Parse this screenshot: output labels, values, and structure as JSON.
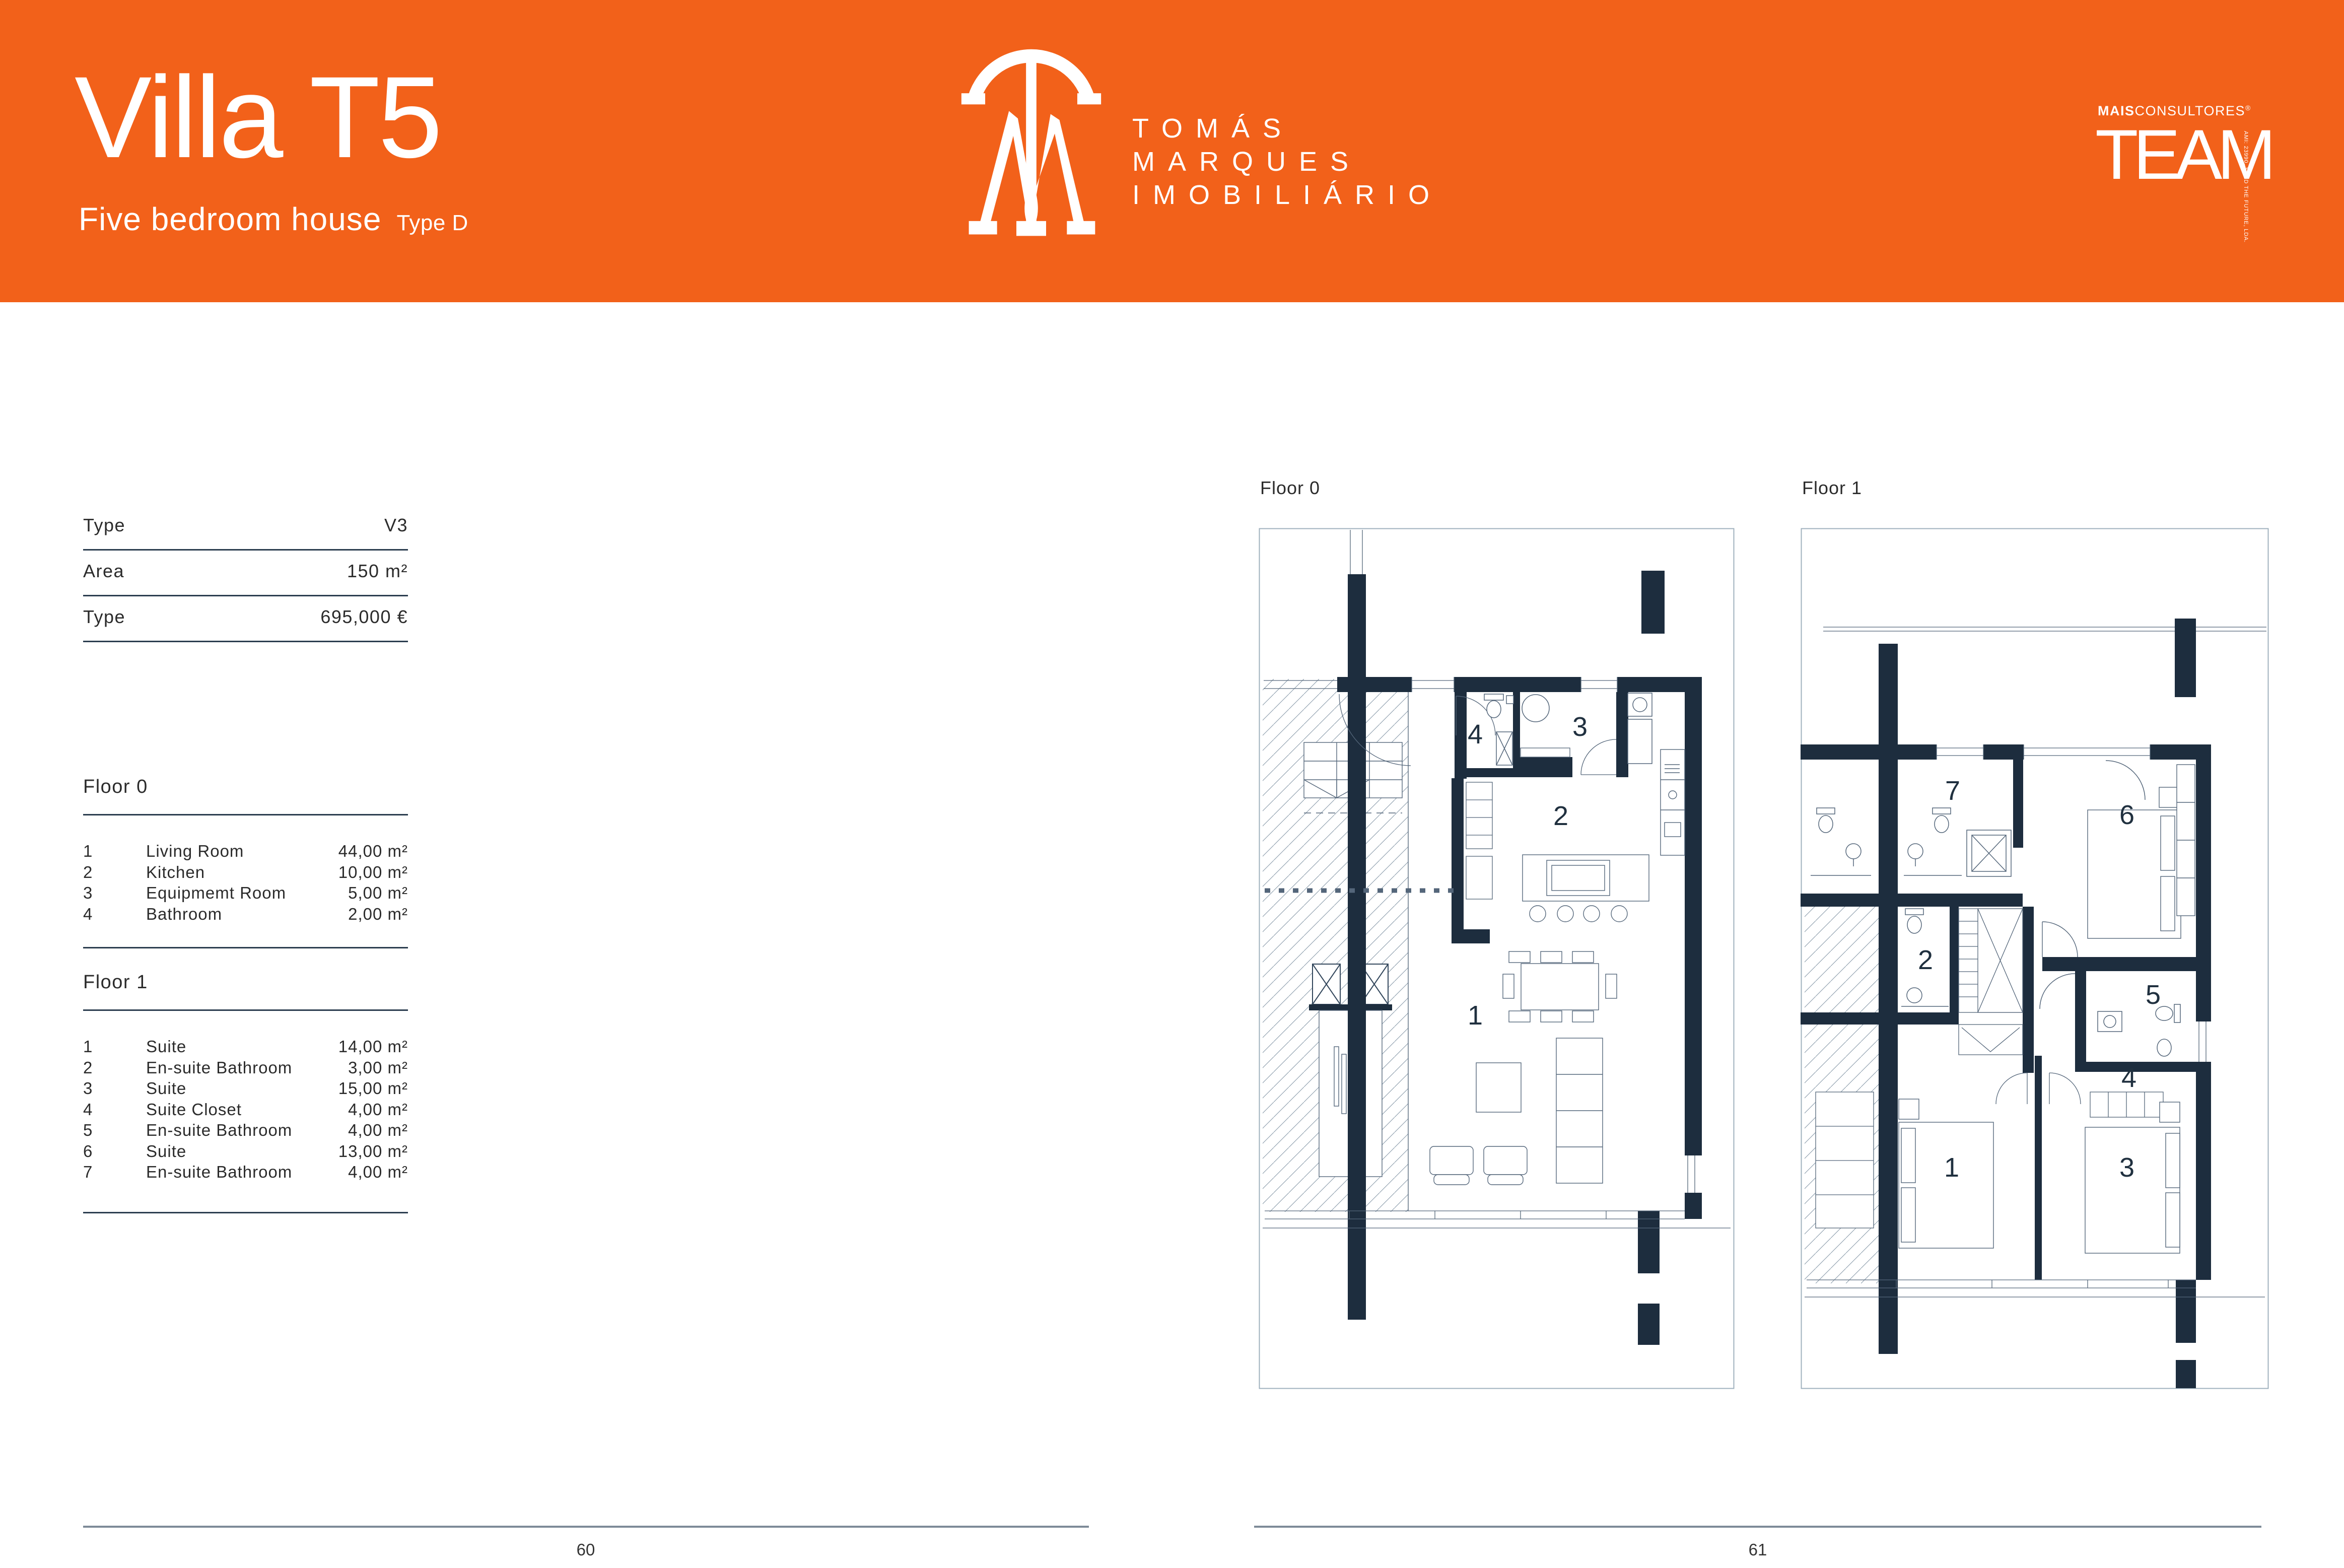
{
  "header": {
    "title": "Villa T5",
    "subtitle": "Five bedroom house",
    "type_tag": "Type D",
    "brand": {
      "line1": "TOMÁS",
      "line2": "MARQUES",
      "line3": "IMOBILIÁRIO"
    },
    "partner": {
      "bold": "MAIS",
      "rest": "CONSULTORES",
      "reg": "®",
      "name": "TEAM",
      "side_note": "AMI: 23990. SEED THE FUTURE, LDA."
    }
  },
  "specs": {
    "rows": [
      {
        "label": "Type",
        "value": "V3"
      },
      {
        "label": "Area",
        "value": "150 m²"
      },
      {
        "label": "Type",
        "value": "695,000 €"
      }
    ]
  },
  "floor0": {
    "heading": "Floor 0",
    "rooms": [
      {
        "n": "1",
        "name": "Living Room",
        "area": "44,00 m²"
      },
      {
        "n": "2",
        "name": "Kitchen",
        "area": "10,00 m²"
      },
      {
        "n": "3",
        "name": "Equipmemt Room",
        "area": "5,00 m²"
      },
      {
        "n": "4",
        "name": "Bathroom",
        "area": "2,00 m²"
      }
    ]
  },
  "floor1": {
    "heading": "Floor 1",
    "rooms": [
      {
        "n": "1",
        "name": "Suite",
        "area": "14,00 m²"
      },
      {
        "n": "2",
        "name": "En-suite Bathroom",
        "area": "3,00 m²"
      },
      {
        "n": "3",
        "name": "Suite",
        "area": "15,00 m²"
      },
      {
        "n": "4",
        "name": "Suite Closet",
        "area": "4,00 m²"
      },
      {
        "n": "5",
        "name": "En-suite Bathroom",
        "area": "4,00 m²"
      },
      {
        "n": "6",
        "name": "Suite",
        "area": "13,00 m²"
      },
      {
        "n": "7",
        "name": "En-suite Bathroom",
        "area": "4,00 m²"
      }
    ]
  },
  "plans": {
    "floor0_label": "Floor 0",
    "floor1_label": "Floor 1",
    "floor0_room_numbers": [
      "1",
      "2",
      "3",
      "4"
    ],
    "floor1_room_numbers": [
      "1",
      "2",
      "3",
      "4",
      "5",
      "6",
      "7"
    ]
  },
  "footer": {
    "left_page": "60",
    "right_page": "61"
  },
  "colors": {
    "orange": "#F2611A",
    "navy": "#1D2D3E",
    "rule": "#2C3E50",
    "footer_line": "#7E8B98"
  }
}
